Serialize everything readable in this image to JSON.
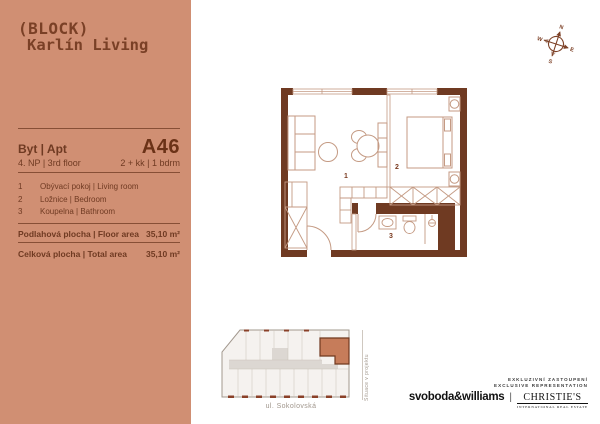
{
  "brand": {
    "logo_line1": "(BLOCK)",
    "logo_line2": "Karlín Living"
  },
  "panel": {
    "unit_label": "Byt | Apt",
    "unit_code": "A46",
    "floor": "4. NP | 3rd floor",
    "layout": "2 + kk | 1 bdrm",
    "rooms": [
      {
        "num": "1",
        "name": "Obývací pokoj | Living room"
      },
      {
        "num": "2",
        "name": "Ložnice | Bedroom"
      },
      {
        "num": "3",
        "name": "Koupelna | Bathroom"
      }
    ],
    "floor_area_label": "Podlahová plocha | Floor area",
    "floor_area_value": "35,10 m²",
    "total_area_label": "Celková plocha | Total area",
    "total_area_value": "35,10 m²"
  },
  "compass": {
    "n": "N",
    "e": "E",
    "s": "S",
    "w": "W"
  },
  "floorplan": {
    "num1": "1",
    "num2": "2",
    "num3": "3"
  },
  "siteplan": {
    "street_bottom": "ul. Sokolovská",
    "side_label": "Situace v projektu"
  },
  "footer": {
    "line1": "EXKLUZIVNÍ ZASTOUPENÍ",
    "line2": "EXCLUSIVE REPRESENTATION",
    "brand1": "svoboda&williams",
    "separator": "|",
    "brand2": "CHRISTIE'S",
    "brand2_sub": "INTERNATIONAL REAL ESTATE"
  },
  "colors": {
    "panel_bg": "#d08f73",
    "dark_brown": "#6f3a22",
    "furniture_line": "#c49a83",
    "unit_highlight": "#c67c5a"
  }
}
